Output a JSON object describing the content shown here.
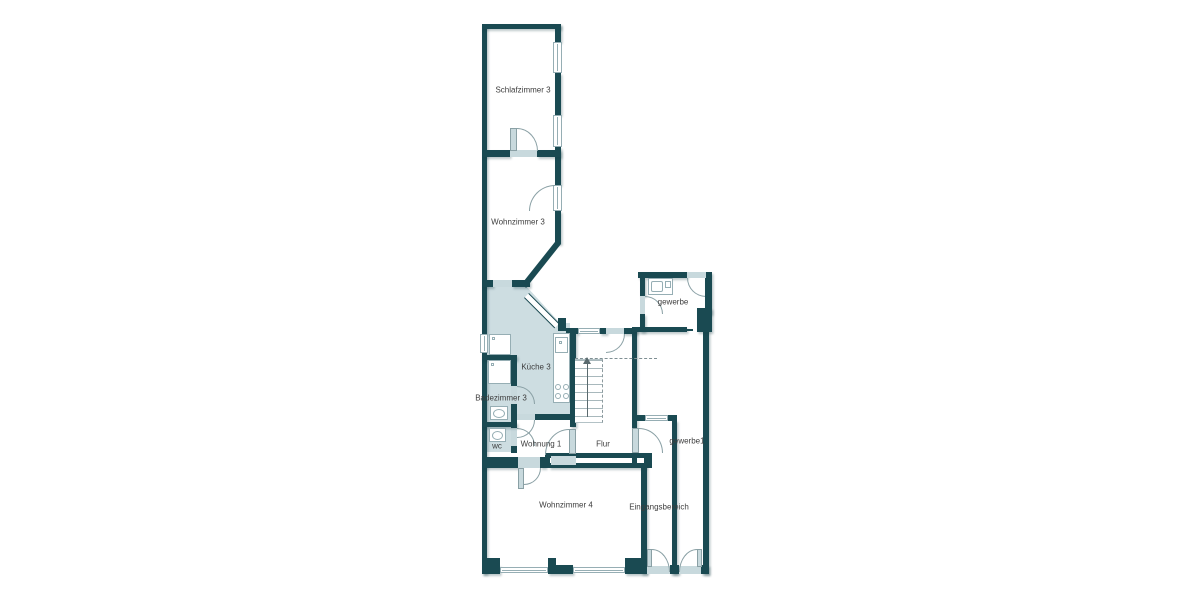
{
  "plan": {
    "type": "floor-plan",
    "highlighted_unit": "Wohnung 1",
    "rooms": [
      {
        "id": "schlafzimmer-3",
        "label": "Schlafzimmer 3"
      },
      {
        "id": "wohnzimmer-3",
        "label": "Wohnzimmer 3"
      },
      {
        "id": "kueche-3",
        "label": "Küche 3"
      },
      {
        "id": "badezimmer-3",
        "label": "Badezimmer 3"
      },
      {
        "id": "wc",
        "label": "wc"
      },
      {
        "id": "wohnung-1",
        "label": "Wohnung 1"
      },
      {
        "id": "flur",
        "label": "Flur"
      },
      {
        "id": "wohnzimmer-4",
        "label": "Wohnzimmer 4"
      },
      {
        "id": "eingangsbereich",
        "label": "Eingangsbereich"
      },
      {
        "id": "gewerbe",
        "label": "gewerbe"
      },
      {
        "id": "gewerbe1",
        "label": "gewerbe1"
      }
    ],
    "features": {
      "staircase_direction": "up",
      "fixtures": [
        "bathtub",
        "washbasin",
        "toilet",
        "kitchen-sink",
        "stove",
        "storage-box",
        "gewerbe-sink"
      ]
    },
    "colors": {
      "wall": "#1A4A52",
      "opening": "#C8D9DD",
      "highlight": "#CDDDE1",
      "fixture_border": "#96AEB4",
      "text": "#3D3D3D",
      "background": "#FFFFFF"
    }
  }
}
